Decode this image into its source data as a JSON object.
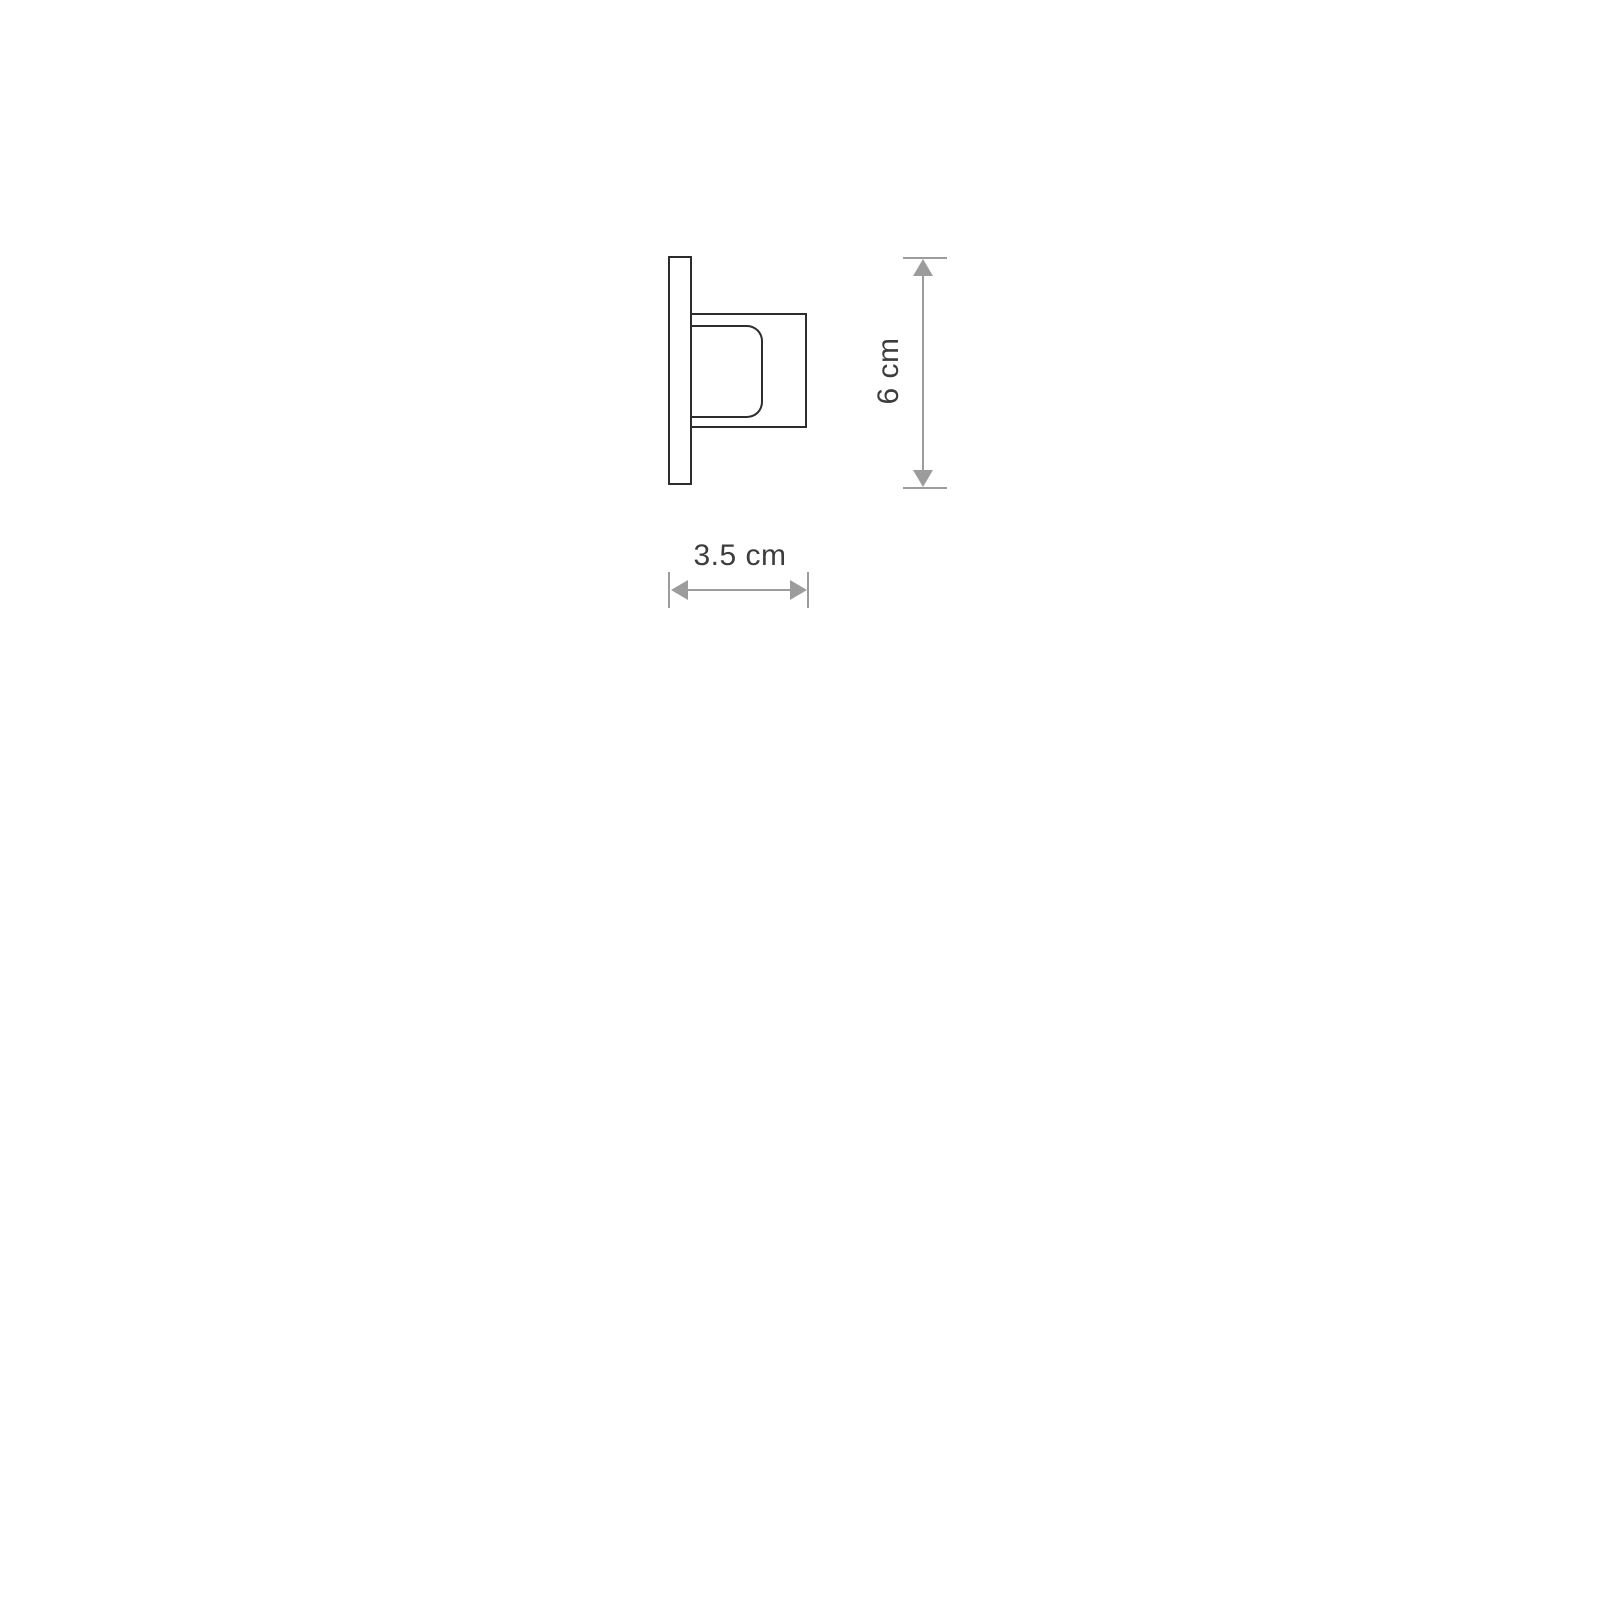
{
  "page": {
    "background": "#ffffff"
  },
  "drawing": {
    "type": "technical-dimension-diagram",
    "subject": "wall-fixture-side-profile",
    "colors": {
      "outline": "#2d2d2d",
      "dimension": "#9c9c9c",
      "text": "#3d3d3d",
      "background": "#ffffff"
    },
    "dimensions": {
      "height": {
        "label": "6 cm",
        "orientation": "vertical"
      },
      "depth": {
        "label": "3.5 cm",
        "orientation": "horizontal"
      }
    }
  }
}
